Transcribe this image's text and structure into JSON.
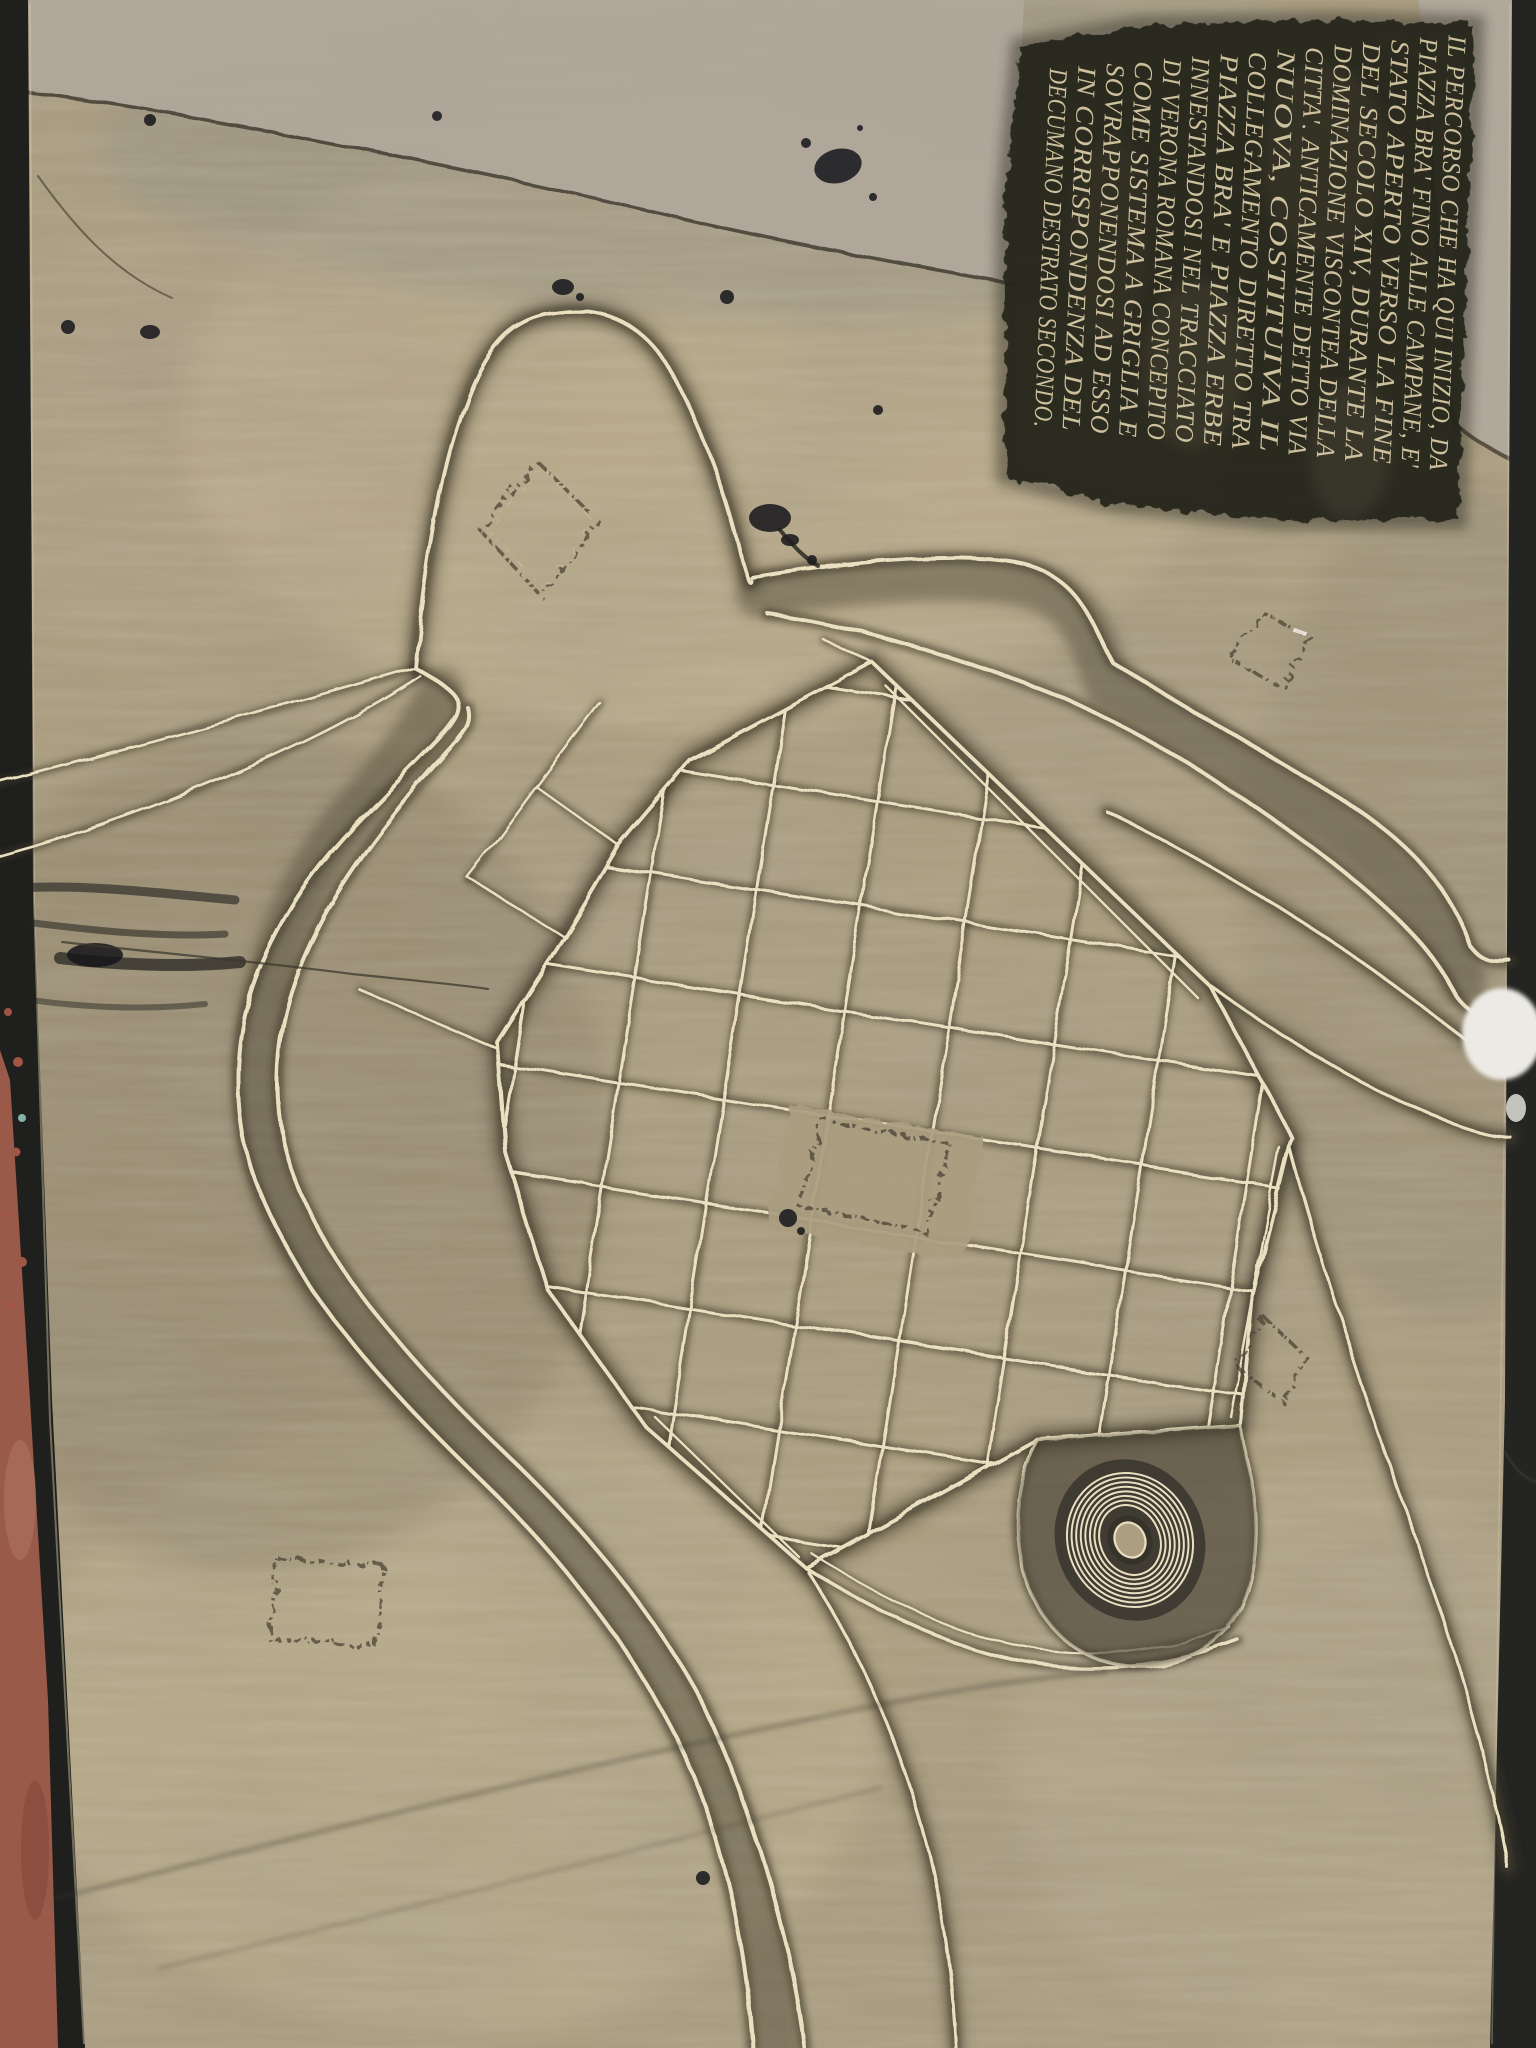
{
  "meta": {
    "title": "Bronze pavement map plaque of Roman Verona",
    "description": "Photograph of an engraved bronze floor plaque showing the plan of Roman Verona: the river loop, the Roman street grid, the Arena amphitheatre and an Italian inscription."
  },
  "inscription": {
    "language": "it",
    "rotation_deg": 92.5,
    "lines": [
      "IL PERCORSO CHE HA QUI INIZIO, DA",
      "PIAZZA BRA' FINO ALLE CAMPANE, E'",
      "STATO APERTO VERSO LA FINE",
      "DEL SECOLO XIV, DURANTE LA",
      "DOMINAZIONE VISCONTEA DELLA",
      "CITTA'. ANTICAMENTE DETTO VIA",
      "NUOVA, COSTITUIVA IL",
      "COLLEGAMENTO DIRETTO TRA",
      "PIAZZA BRA' E PIAZZA ERBE",
      "INNESTANDOSI NEL TRACCIATO",
      "DI VERONA ROMANA CONCEPITO",
      "COME SISTEMA A GRIGLIA E",
      "SOVRAPPONENDOSI AD ESSO",
      "IN CORRISPONDENZA DEL",
      "DECUMANO DESTRATO SECONDO."
    ]
  },
  "map": {
    "features": [
      "river-loop-band",
      "roman-street-grid",
      "arena-amphitheatre-rings",
      "arch-gate-outline",
      "western-approach-roads",
      "eastern-exit-roads",
      "building-plot-diamonds",
      "forum-block"
    ],
    "grid": {
      "tilt_deg": 9,
      "cx": 880,
      "cy": 1120,
      "v_lines": {
        "x_start": 510,
        "step": 106,
        "count": 8,
        "y1": 610,
        "y2": 1630
      },
      "h_lines": {
        "y_start": 700,
        "step": 106,
        "count": 9,
        "x1": 430,
        "x2": 1340
      }
    },
    "arena": {
      "cx": 1130,
      "cy": 1540,
      "rings": 8,
      "outer_rx": 62,
      "outer_ry": 68,
      "ring_step": 4.6,
      "rotate_deg": -24
    }
  },
  "colors": {
    "bronze": "#ab9e81",
    "bronze_light": "#c6b795",
    "bronze_dark": "#8c8169",
    "grime": "#55503e",
    "line": "#eadfc0",
    "halo": "#3e392c",
    "concrete": "#b1a89d",
    "edge_black": "#1f1f1d",
    "pavement_red": "#9a5a49",
    "inscription_bg": "#26251f",
    "inscription_text": "#d6c9a4",
    "paint_white": "#eceae4"
  }
}
